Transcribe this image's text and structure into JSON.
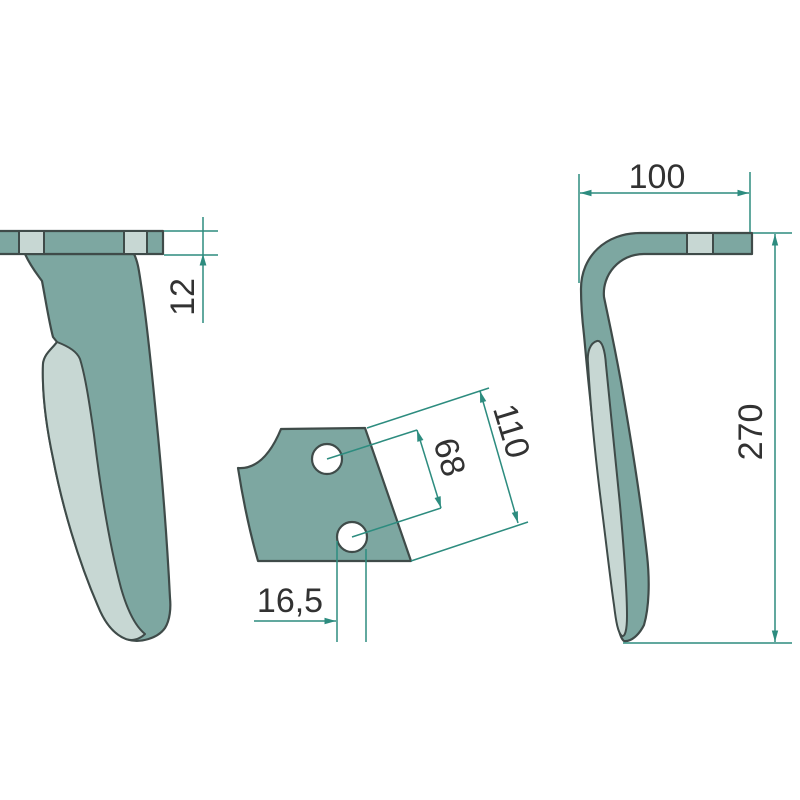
{
  "dims": {
    "thickness": "12",
    "arm_width": "100",
    "overall_height": "270",
    "blade_length": "110",
    "hole_spacing": "68",
    "hole_offset": "16,5"
  },
  "colors": {
    "part_dark": "#7da7a1",
    "part_light": "#c7d7d3",
    "outline": "#3f4b49",
    "dimension_lines": "#2d8c7f",
    "label_text": "#323232",
    "background": "#ffffff"
  }
}
